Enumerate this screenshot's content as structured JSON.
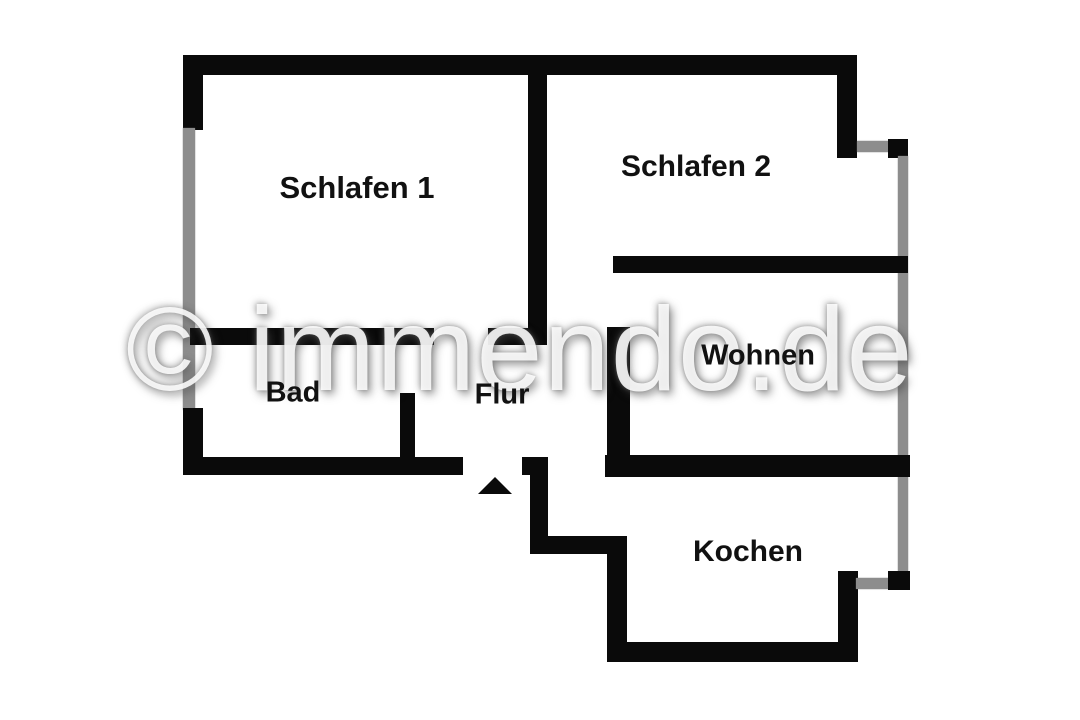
{
  "watermark": {
    "text": "© immendo.de"
  },
  "rooms": [
    {
      "id": "schlafen1",
      "label": "Schlafen 1"
    },
    {
      "id": "schlafen2",
      "label": "Schlafen 2"
    },
    {
      "id": "bad",
      "label": "Bad"
    },
    {
      "id": "flur",
      "label": "Flur"
    },
    {
      "id": "wohnen",
      "label": "Wohnen"
    },
    {
      "id": "kochen",
      "label": "Kochen"
    }
  ],
  "colors": {
    "wall": "#0a0a0a",
    "window": "#8d8d8d",
    "background": "#ffffff",
    "label_text": "#111111",
    "watermark_text": "#ffffff"
  },
  "icons": {
    "entrance_arrow": "up-triangle"
  }
}
